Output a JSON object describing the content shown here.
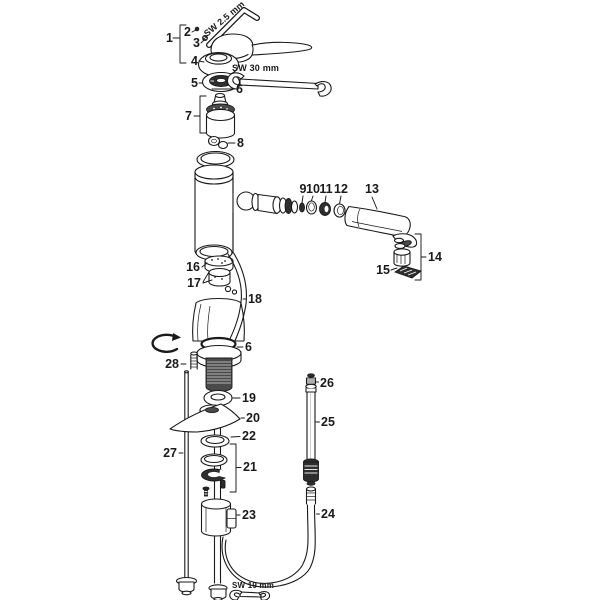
{
  "figure": {
    "background": "#ffffff",
    "line_color": "#1a1a1a",
    "dark_fill": "#2e2e2e"
  },
  "callouts": {
    "c1": "1",
    "c2": "2",
    "c3": "3",
    "c4": "4",
    "c5": "5",
    "c6": "6",
    "c7": "7",
    "c8": "8",
    "c9": "9",
    "c10": "10",
    "c11": "11",
    "c12": "12",
    "c13": "13",
    "c14": "14",
    "c15": "15",
    "c16": "16",
    "c17": "17",
    "c18": "18",
    "c19": "19",
    "c20": "20",
    "c21": "21",
    "c22": "22",
    "c23": "23",
    "c24": "24",
    "c25": "25",
    "c26": "26",
    "c27": "27",
    "c28": "28"
  },
  "tools": {
    "allen_key": "SW 2.5 mm",
    "wrench_large": "SW 30 mm",
    "wrench_small": "SW 19 mm"
  }
}
